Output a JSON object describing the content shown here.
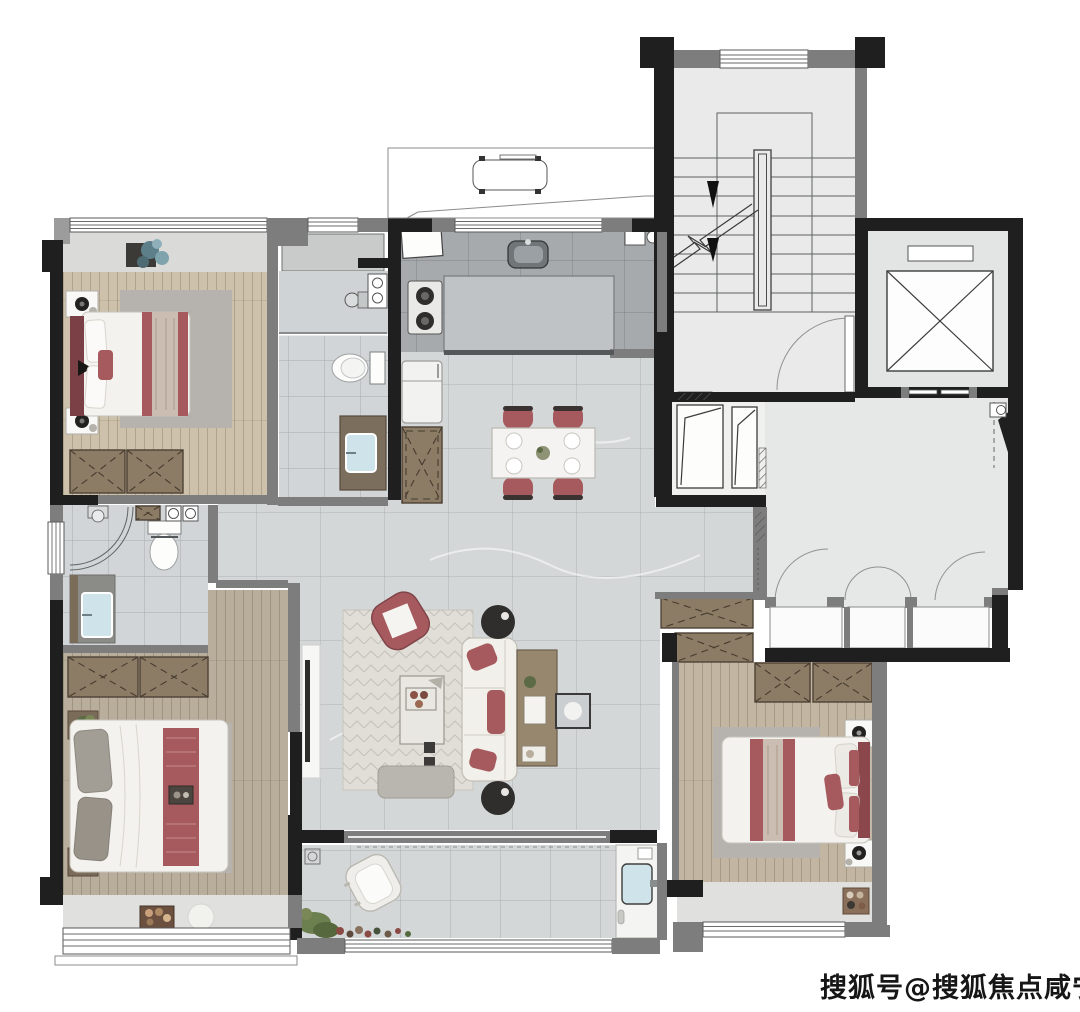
{
  "watermark": {
    "text": "搜狐号@搜狐焦点咸宁站"
  },
  "colors": {
    "wall": "#1f1f1f",
    "wall-gray": "#7d7d7d",
    "window-frame": "#5a5a5a",
    "marble-light": "#d4d7d8",
    "marble-dark": "#a6aaad",
    "bath-tile": "#d2d5d7",
    "stair-floor": "#e9eae9",
    "hall-floor": "#e6e8e7",
    "wood-light": "#cdc1ab",
    "wood-master": "#b9ad9c",
    "wood-bedroom": "#c2b6a3",
    "cabinet-brown": "#8c7c66",
    "accent-red": "#a65a5e",
    "accent-red-dark": "#8c474c",
    "duvet-white": "#f3f2ee",
    "rug-gray": "#b6b3ae",
    "rug-living": "#e0ded7",
    "sofa-white": "#f2f0ea",
    "console-wood": "#97876f",
    "sink-blue": "#cfe3ea",
    "plant-green": "#6c7f4e"
  }
}
